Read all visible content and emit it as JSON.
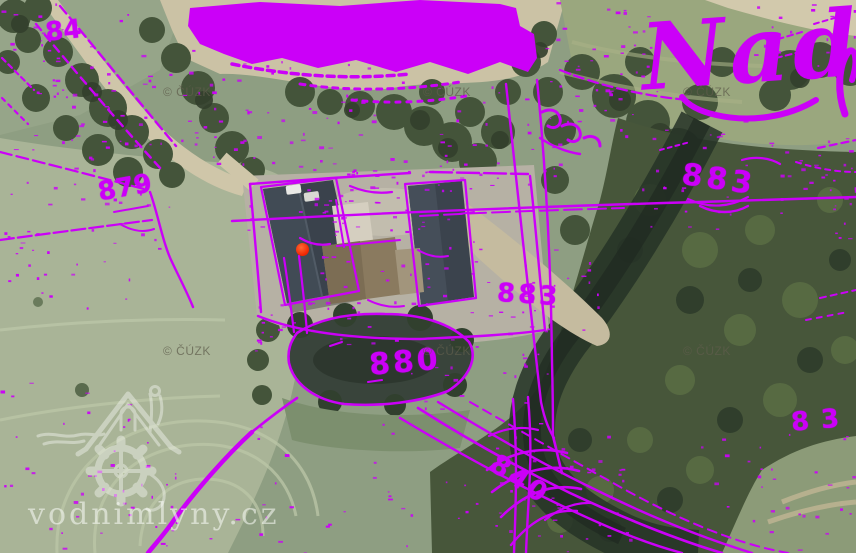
{
  "map": {
    "overlay_color": "#cb00f8",
    "marker_color": "#ef2400"
  },
  "labels": {
    "place_name": "Nad",
    "parcels": [
      {
        "text": "84"
      },
      {
        "text": "879"
      },
      {
        "text": "883"
      },
      {
        "text": "883"
      },
      {
        "text": "880"
      },
      {
        "text": "840"
      },
      {
        "text": "83"
      }
    ]
  },
  "watermarks": {
    "provider": "© ČÚZK",
    "site": "vodnimlyny.cz"
  }
}
